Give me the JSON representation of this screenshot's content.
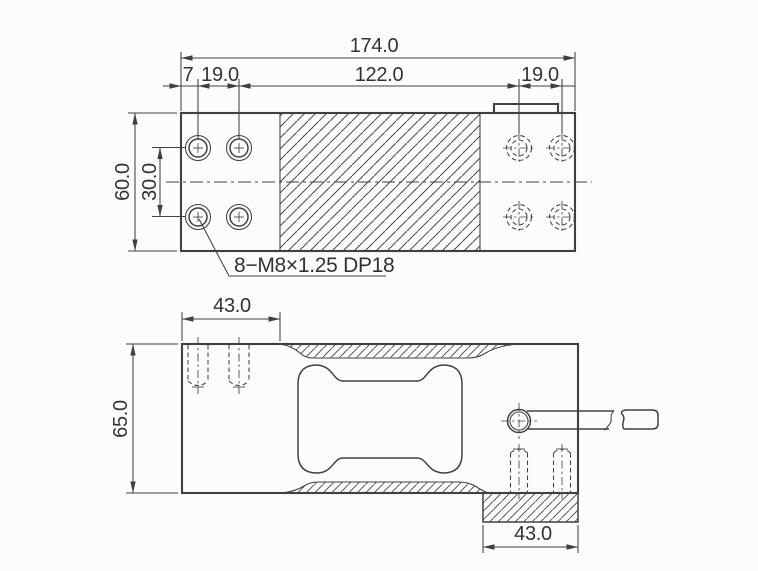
{
  "colors": {
    "line": "#404040",
    "text": "#333333",
    "background": "#fcfcfc"
  },
  "top_view": {
    "dim_total_width": "174.0",
    "dim_edge_offset": "7",
    "dim_hole_pitch_left": "19.0",
    "dim_center_span": "122.0",
    "dim_hole_pitch_right": "19.0",
    "dim_body_height": "60.0",
    "dim_hole_row_pitch": "30.0",
    "thread_note": "8−M8×1.25 DP18"
  },
  "side_view": {
    "dim_mount_left": "43.0",
    "dim_body_height": "65.0",
    "dim_mount_right": "43.0"
  }
}
